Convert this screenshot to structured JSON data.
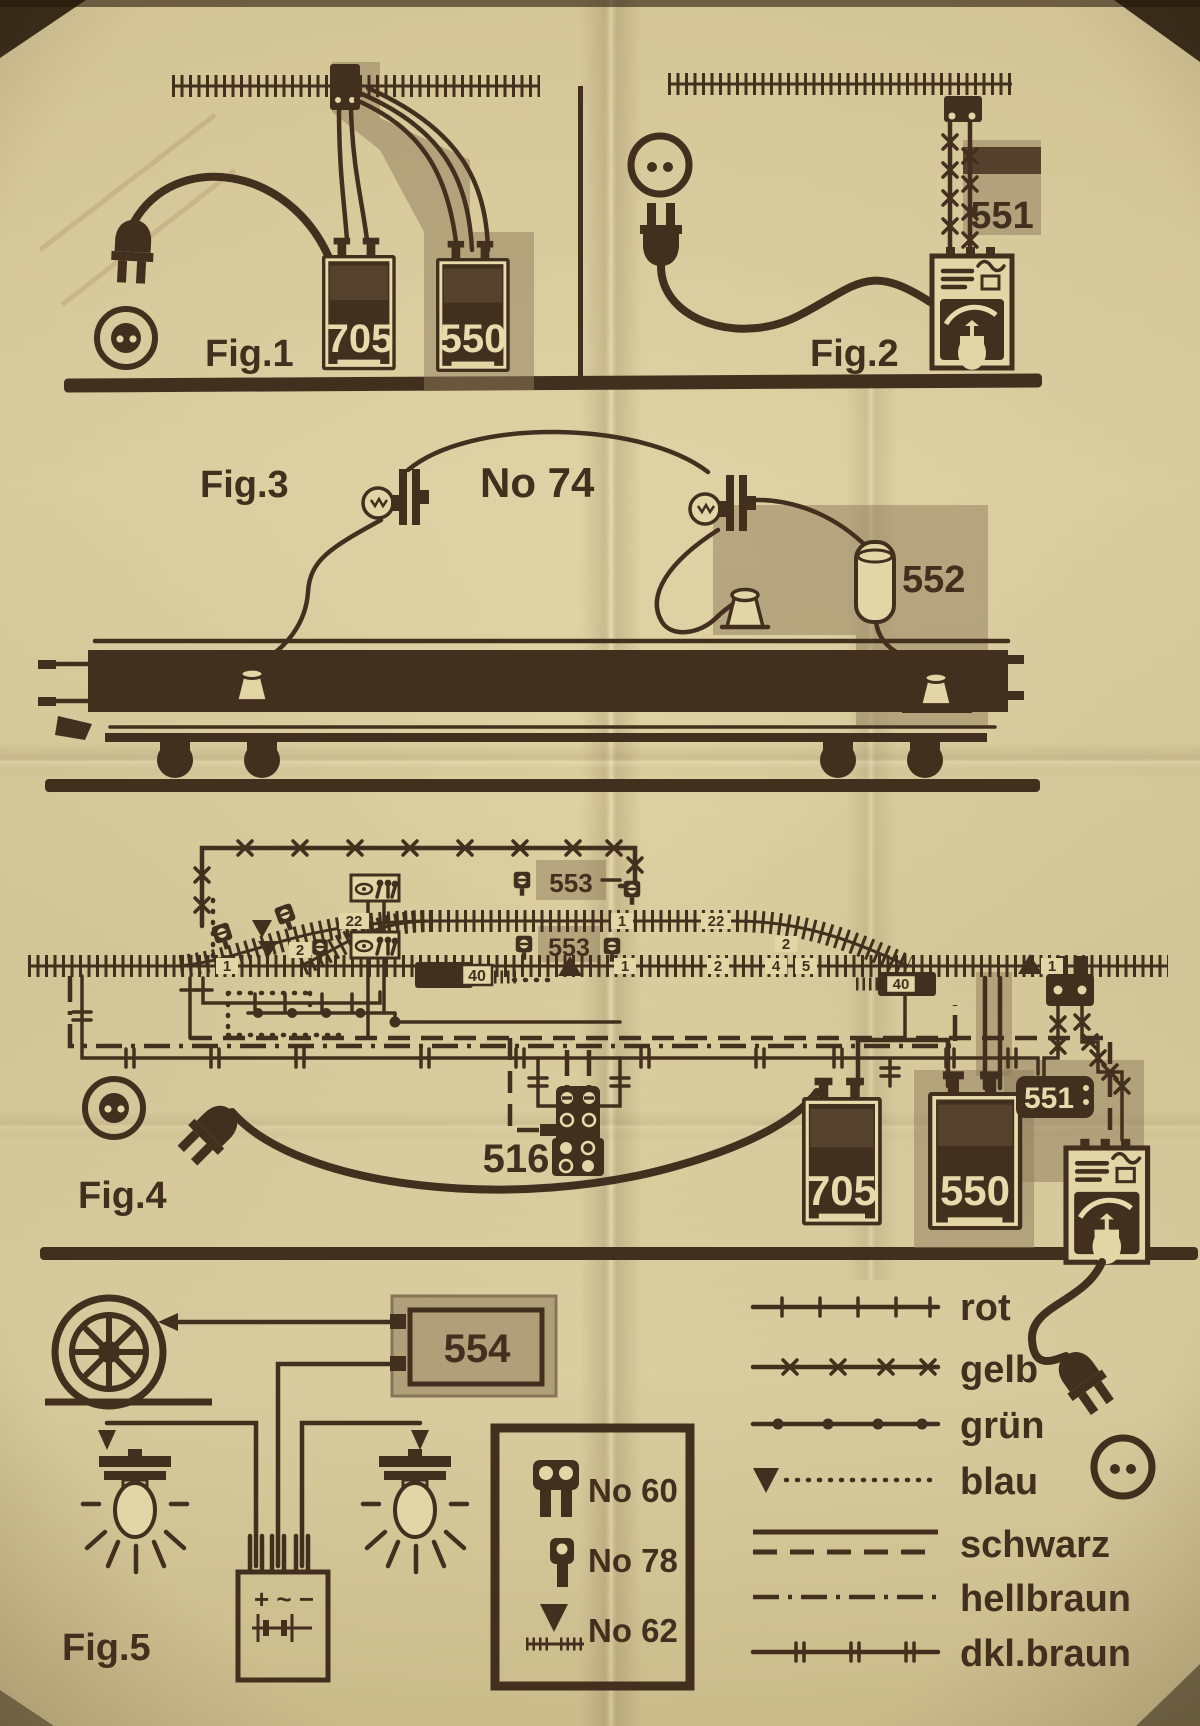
{
  "colors": {
    "paper": "#e0d4a4",
    "ink": "#42301f",
    "highlight": "#8f7c5c",
    "light_text": "#e6dbab"
  },
  "fig1": {
    "label": "Fig.1",
    "transformer": "705",
    "device": "550"
  },
  "fig2": {
    "label": "Fig.2",
    "device": "551"
  },
  "fig3": {
    "label": "Fig.3",
    "lamp_part": "No 74",
    "device": "552"
  },
  "fig4": {
    "label": "Fig.4",
    "signal_units": [
      "553",
      "553"
    ],
    "track_contacts": [
      "40",
      "40"
    ],
    "distributor": "516",
    "transformer": "705",
    "device": "550",
    "controller": "551",
    "track_tags": [
      "1",
      "22",
      "2",
      "1",
      "22",
      "2",
      "1",
      "2",
      "4",
      "5",
      "1"
    ]
  },
  "fig5": {
    "label": "Fig.5",
    "device": "554",
    "terminal_marks": "+ ~ −"
  },
  "parts_legend": {
    "items": [
      "No 60",
      "No 78",
      "No 62"
    ]
  },
  "color_legend": {
    "items": [
      "rot",
      "gelb",
      "grün",
      "blau",
      "schwarz",
      "hellbraun",
      "dkl.braun"
    ]
  }
}
